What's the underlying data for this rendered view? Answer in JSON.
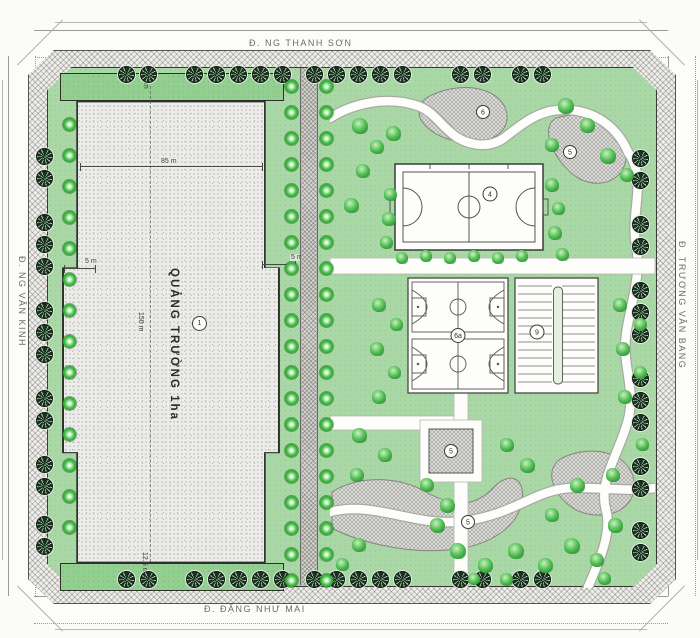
{
  "streets": {
    "top": "Đ. NG THANH SƠN",
    "bottom": "Đ. ĐẶNG NHƯ MAI",
    "left": "Đ. NG VĂN KINH",
    "right": "Đ. TRƯƠNG VĂN BANG"
  },
  "plaza": {
    "label": "QUẢNG TRƯỜNG 1ha",
    "marker": "1"
  },
  "dimensions": {
    "top_strip": "5 m",
    "plaza_width": "85 m",
    "plaza_height": "150 m",
    "bottom_strip": "12.5 m",
    "notch_left": "5 m",
    "notch_right": "5 m"
  },
  "markers": {
    "football_field": "4",
    "basketball_courts": "6a",
    "parking": "9",
    "multi_court": "5",
    "south_plaza": "5",
    "north_plaza": "6",
    "east_path": "5"
  },
  "colors": {
    "lawn": "#a9d8a6",
    "plaza_fill": "#ececea",
    "hatch_plaza": "#dadad7",
    "tree_green": "#3fae3f",
    "street_tree": "#17321d",
    "line": "#444440",
    "path_white": "#fdfdfb"
  }
}
